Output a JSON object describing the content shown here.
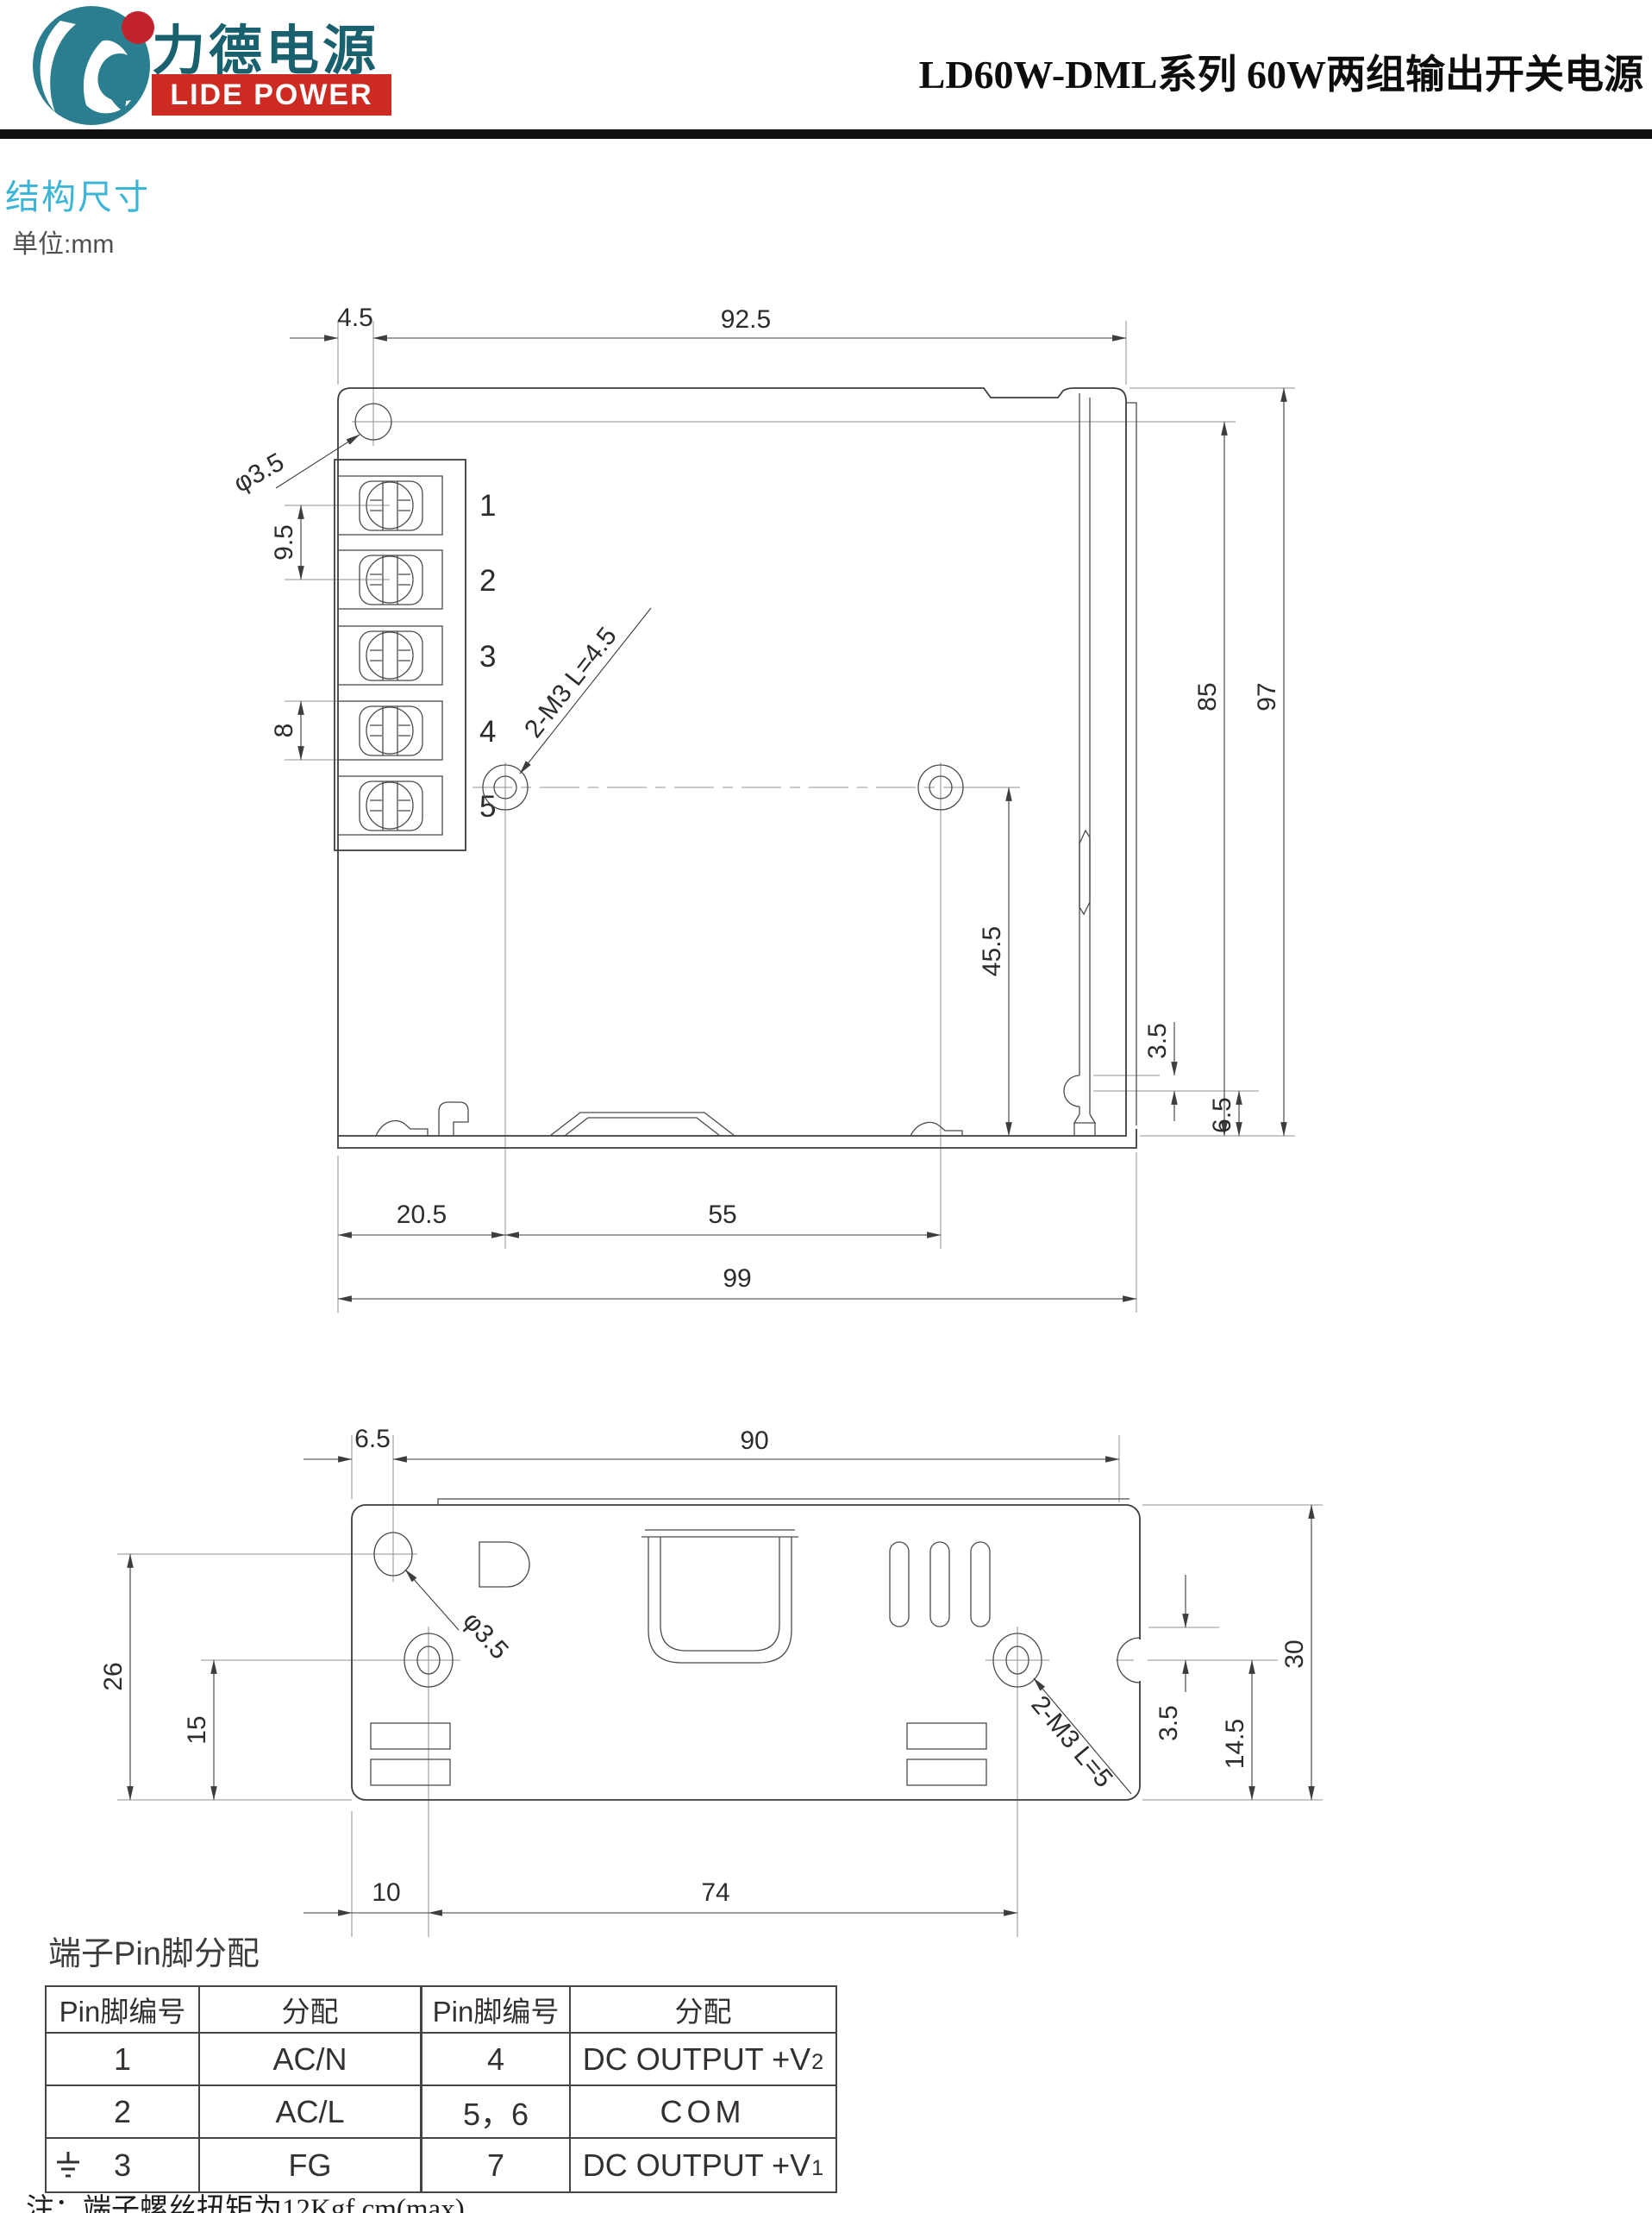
{
  "header": {
    "logo_cn": "力德电源",
    "logo_en": "LIDE POWER",
    "title": "LD60W-DML系列 60W两组输出开关电源",
    "brand_teal": "#2a7e90",
    "brand_red": "#c3232c"
  },
  "section": {
    "title": "结构尺寸",
    "unit": "单位:mm"
  },
  "drawing1": {
    "terminals": [
      "1",
      "2",
      "3",
      "4",
      "5"
    ],
    "dims": {
      "top_offset": "4.5",
      "top_width": "92.5",
      "hole_dia": "φ3.5",
      "pitch_a": "9.5",
      "pitch_b": "8",
      "screw_note": "2-M3 L=4.5",
      "inner_height": "85",
      "total_height": "97",
      "center_to_bottom": "45.5",
      "flange_a": "3.5",
      "flange_b": "6.5",
      "bottom_a": "20.5",
      "bottom_b": "55",
      "bottom_total": "99"
    }
  },
  "drawing2": {
    "dims": {
      "left_offset": "6.5",
      "top_width": "90",
      "hole_dia": "φ3.5",
      "left_height": "26",
      "screw_height": "15",
      "screw_note": "2-M3 L=5",
      "notch_a": "3.5",
      "screw_to_bottom": "14.5",
      "total_height": "30",
      "bottom_a": "10",
      "bottom_b": "74"
    }
  },
  "pin_table": {
    "title": "端子Pin脚分配",
    "headers": [
      "Pin脚编号",
      "分配",
      "Pin脚编号",
      "分配"
    ],
    "rows": [
      {
        "pin_l": "1",
        "assign_l": "AC/N",
        "pin_r": "4",
        "assign_r": "DC OUTPUT +V",
        "assign_r_sub": "2"
      },
      {
        "pin_l": "2",
        "assign_l": "AC/L",
        "pin_r": "5，6",
        "assign_r": "COM",
        "assign_r_sub": ""
      },
      {
        "pin_l": "3",
        "assign_l": "FG",
        "pin_r": "7",
        "assign_r": "DC OUTPUT +V",
        "assign_r_sub": "1"
      }
    ],
    "note": "注：端子螺丝扭矩为12Kgf.cm(max)"
  }
}
